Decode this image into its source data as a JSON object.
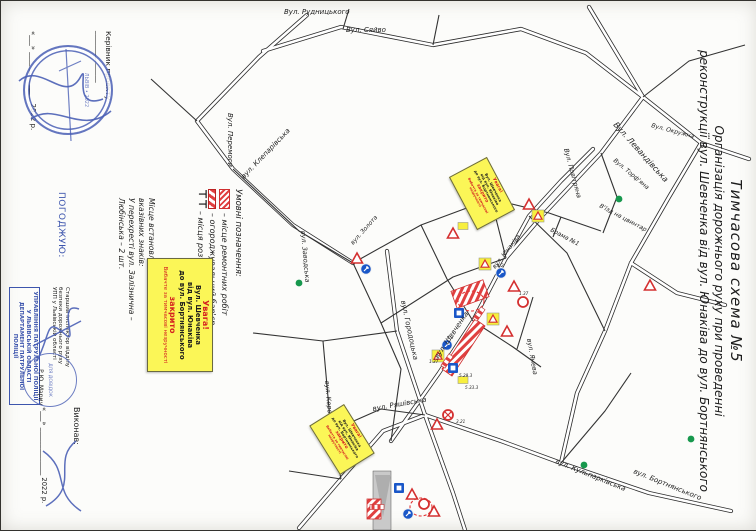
{
  "document": {
    "title_lines": [
      "Тимчасова схема №5",
      "Організація дорожнього руху при проведенні",
      "реконструкції вул. Шевченка від вул. Юнаківа до вул. Бортнянського"
    ]
  },
  "approvals": {
    "kerivnyk_line": "Керівник проекту ______________",
    "kerivnyk_date": "«___» ______________ 2022 р.",
    "pogodzhuyu": "ПОГОДЖУЮ:",
    "police_officer_lines": [
      "Старший інспектор відділу",
      "безпеки дорожнього руху",
      "УПП у Львівській області"
    ],
    "police_officer_name": "Р.Ю. Марич",
    "police_stamp_lines": [
      "УПРАВЛІННЯ ПАТРУЛЬНОЇ ПОЛІЦІЇ",
      "У ЛЬВІВСЬКІЙ ОБЛАСТІ",
      "ДЕПАРТАМЕНТ ПАТРУЛЬНОЇ ПОЛІЦІЇ"
    ],
    "dovidok_stamp": "ДЛЯ ДОВІДОК",
    "round_stamp_center": "ЛЬВІВ • 2022",
    "vykonav": "Виконав:",
    "vykonav_date": "«___» ______________ 2022 р."
  },
  "legend": {
    "heading": "Умовні позначення:",
    "items": [
      {
        "symbol": "repair",
        "label": "– місце ремонтних робіт"
      },
      {
        "symbol": "barrier",
        "label": "– огороджувальний бар'єр"
      },
      {
        "symbol": "dz",
        "label": "– місця розташування ДЗ"
      }
    ]
  },
  "info_note": {
    "lines": [
      "Місце встановлення інформаційно-",
      "вказівних знаків:",
      "У перехресті вул. Залізнична –",
      "Любінська – 2 шт."
    ]
  },
  "warning_box": {
    "lines": [
      {
        "t": "Увага!",
        "c": "red",
        "v": "big"
      },
      {
        "t": "Вул. Шевченка",
        "c": "k",
        "v": ""
      },
      {
        "t": "від вул. Юнаківа",
        "c": "k",
        "v": ""
      },
      {
        "t": "до вул. Бортнянського",
        "c": "k",
        "v": ""
      },
      {
        "t": "закрито",
        "c": "red",
        "v": "big"
      },
      {
        "t": "Вибачте за тимчасові незручності",
        "c": "red",
        "v": "sm"
      }
    ]
  },
  "map": {
    "street_labels": [
      {
        "t": "Вул. Рудницького",
        "x": 283,
        "y": 13,
        "r": 0,
        "s": 7
      },
      {
        "t": "Вул. Сяйво",
        "x": 345,
        "y": 31,
        "r": 0,
        "s": 7
      },
      {
        "t": "Вул. Перемоги",
        "x": 227,
        "y": 112,
        "r": 90,
        "s": 7
      },
      {
        "t": "Вул. Левандівська",
        "x": 612,
        "y": 124,
        "r": 48,
        "s": 8
      },
      {
        "t": "Вул. Повітряна",
        "x": 563,
        "y": 148,
        "r": 75,
        "s": 6.5
      },
      {
        "t": "Вул. Торф'яна",
        "x": 612,
        "y": 160,
        "r": 40,
        "s": 6
      },
      {
        "t": "Вул. Окружна",
        "x": 650,
        "y": 126,
        "r": 15,
        "s": 6
      },
      {
        "t": "вул. Клепарівська",
        "x": 243,
        "y": 178,
        "r": -46,
        "s": 7
      },
      {
        "t": "вул. Заводська",
        "x": 300,
        "y": 230,
        "r": 85,
        "s": 6.5
      },
      {
        "t": "вул. Золота",
        "x": 352,
        "y": 244,
        "r": -48,
        "s": 6
      },
      {
        "t": "вул. Шевченка",
        "x": 437,
        "y": 358,
        "r": -56,
        "s": 7
      },
      {
        "t": "вул. Юнаківа",
        "x": 494,
        "y": 268,
        "r": -52,
        "s": 6
      },
      {
        "t": "вул. Янева",
        "x": 526,
        "y": 338,
        "r": 80,
        "s": 6.5
      },
      {
        "t": "вул. Городоцька",
        "x": 400,
        "y": 300,
        "r": 78,
        "s": 7
      },
      {
        "t": "вул. Ряшівська",
        "x": 372,
        "y": 410,
        "r": -10,
        "s": 7
      },
      {
        "t": "вул. Королева",
        "x": 324,
        "y": 380,
        "r": 85,
        "s": 6.5
      },
      {
        "t": "вул. Кульпарківська",
        "x": 554,
        "y": 462,
        "r": 22,
        "s": 7
      },
      {
        "t": "вул. Бортнянського",
        "x": 632,
        "y": 472,
        "r": 22,
        "s": 7
      },
      {
        "t": "В'їзд на цвинтар",
        "x": 598,
        "y": 206,
        "r": 28,
        "s": 6
      },
      {
        "t": "Брама №1",
        "x": 549,
        "y": 230,
        "r": 28,
        "s": 6
      }
    ],
    "sign_codes": [
      {
        "t": "4.2",
        "x": 446,
        "y": 338
      },
      {
        "t": "1.37",
        "x": 428,
        "y": 362
      },
      {
        "t": "5.29.3",
        "x": 458,
        "y": 376
      },
      {
        "t": "5.33.3",
        "x": 464,
        "y": 388
      },
      {
        "t": "3.21",
        "x": 455,
        "y": 422
      },
      {
        "t": "4.2",
        "x": 496,
        "y": 266
      },
      {
        "t": "1.37",
        "x": 518,
        "y": 294
      }
    ],
    "signs": [
      {
        "k": "tw",
        "x": 528,
        "y": 204
      },
      {
        "k": "ty",
        "x": 537,
        "y": 215
      },
      {
        "k": "yp",
        "x": 462,
        "y": 225
      },
      {
        "k": "tw",
        "x": 452,
        "y": 233
      },
      {
        "k": "gd",
        "x": 298,
        "y": 282
      },
      {
        "k": "gd",
        "x": 618,
        "y": 198
      },
      {
        "k": "gd",
        "x": 583,
        "y": 464
      },
      {
        "k": "gd",
        "x": 690,
        "y": 438
      },
      {
        "k": "cb",
        "x": 500,
        "y": 272
      },
      {
        "k": "tw",
        "x": 513,
        "y": 286
      },
      {
        "k": "ty",
        "x": 484,
        "y": 263
      },
      {
        "k": "cr",
        "x": 522,
        "y": 301
      },
      {
        "k": "sb",
        "x": 458,
        "y": 312
      },
      {
        "k": "ty",
        "x": 492,
        "y": 318
      },
      {
        "k": "tw",
        "x": 506,
        "y": 331
      },
      {
        "k": "cb",
        "x": 446,
        "y": 344
      },
      {
        "k": "ty",
        "x": 437,
        "y": 355
      },
      {
        "k": "sb",
        "x": 452,
        "y": 367
      },
      {
        "k": "yp",
        "x": 462,
        "y": 379
      },
      {
        "k": "cx",
        "x": 447,
        "y": 414
      },
      {
        "k": "tw",
        "x": 436,
        "y": 424
      },
      {
        "k": "tw",
        "x": 356,
        "y": 258
      },
      {
        "k": "cb",
        "x": 365,
        "y": 268
      },
      {
        "k": "sb",
        "x": 398,
        "y": 487
      },
      {
        "k": "tw",
        "x": 411,
        "y": 494
      },
      {
        "k": "cr",
        "x": 423,
        "y": 503
      },
      {
        "k": "tw",
        "x": 433,
        "y": 511
      },
      {
        "k": "cb",
        "x": 407,
        "y": 513
      },
      {
        "k": "bar",
        "x": 376,
        "y": 506,
        "r": 0
      },
      {
        "k": "bar",
        "x": 446,
        "y": 360,
        "r": -55
      },
      {
        "k": "bar",
        "x": 478,
        "y": 313,
        "r": -55
      },
      {
        "k": "tw",
        "x": 649,
        "y": 285
      }
    ]
  }
}
